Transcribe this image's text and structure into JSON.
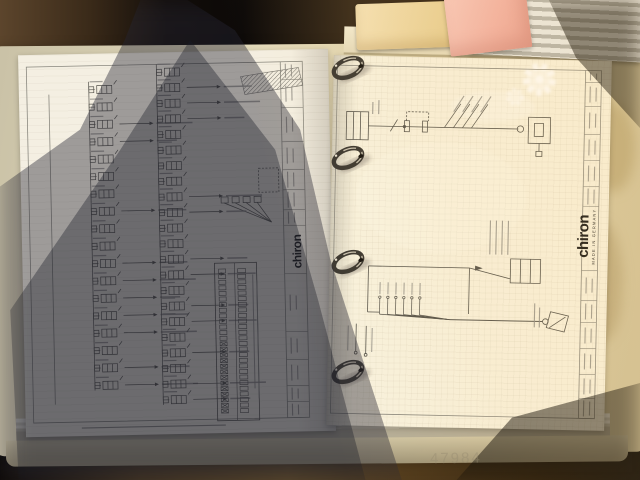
{
  "photo": {
    "bottom_watermark": "47984"
  },
  "binder": {
    "left_page_logo": "chiron",
    "right_page_logo": "chiron",
    "right_page_logo_subtitle": "MADE IN GERMANY",
    "rings": [
      {
        "y": 30
      },
      {
        "y": 120
      },
      {
        "y": 224
      },
      {
        "y": 334
      }
    ]
  },
  "left_schematic": {
    "column_a": {
      "x_bus": 70,
      "x_sym": 78,
      "y_start": 36,
      "step": 17.4,
      "count": 18,
      "arrow_rows": [
        2,
        3,
        7,
        10,
        11,
        12,
        13,
        14,
        16,
        17
      ]
    },
    "column_b": {
      "x_bus": 138,
      "x_sym": 146,
      "y_start": 20,
      "step": 15.6,
      "count": 22,
      "arrow_rows": [
        1,
        2,
        3,
        8,
        9,
        12,
        13,
        15,
        16,
        18,
        20,
        21
      ]
    },
    "terminal_strip": {
      "x": 196,
      "y": 218,
      "rows": 26,
      "row_step": 5.6,
      "cross_from_row": 13
    },
    "title_cells_y": [
      30,
      58,
      92,
      120,
      140,
      160,
      176,
      224,
      282,
      310,
      336,
      352
    ]
  },
  "right_schematic": {
    "diagonal_labels": 4,
    "bundle_wires": 6,
    "title_cells_y": [
      22,
      46,
      74,
      100,
      126,
      146,
      210,
      240,
      262,
      288,
      314,
      338
    ]
  },
  "colors": {
    "ink": "#55534c",
    "squiggle": "#8f8d86",
    "ring_dark": "#3a3731",
    "ring_light": "#c9c2b0",
    "paper": "#f5f0e1",
    "cover": "#ddd3b4",
    "desk": "#241a10",
    "sticky_pink": "#f1afa4",
    "sticky_yellow": "#ecd59e"
  }
}
